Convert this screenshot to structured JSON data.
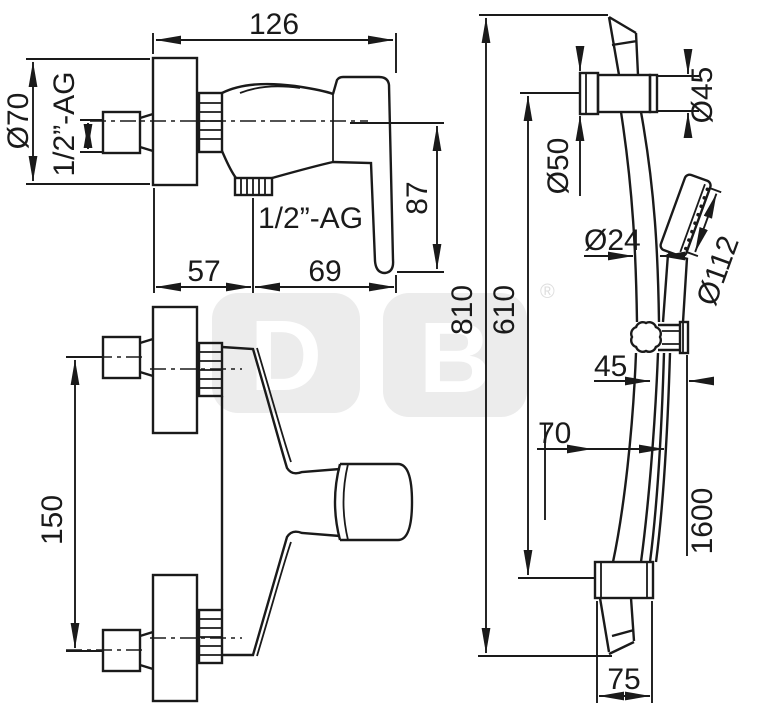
{
  "drawing": {
    "side_view": {
      "width": "126",
      "rosette_dia": "Ø70",
      "inlet_thread": "1/2”-AG",
      "outlet_thread": "1/2”-AG",
      "handle_drop": "87",
      "wall_to_outlet": "57",
      "outlet_to_handle": "69"
    },
    "plan_view": {
      "port_spacing": "150"
    },
    "rail_view": {
      "total_height": "810",
      "rail_length": "610",
      "bracket_dia": "Ø45",
      "flange_dia": "Ø50",
      "tube_dia": "Ø24",
      "head_dia": "Ø112",
      "slider_offset": "45",
      "wall_offset": "70",
      "hose_length": "1600",
      "bracket_width": "75"
    }
  },
  "watermark": {
    "letter_left": "D",
    "letter_right": "B",
    "registered": "®"
  },
  "colors": {
    "line": "#1a1a1a",
    "watermark": "#ececec",
    "background": "#ffffff"
  }
}
